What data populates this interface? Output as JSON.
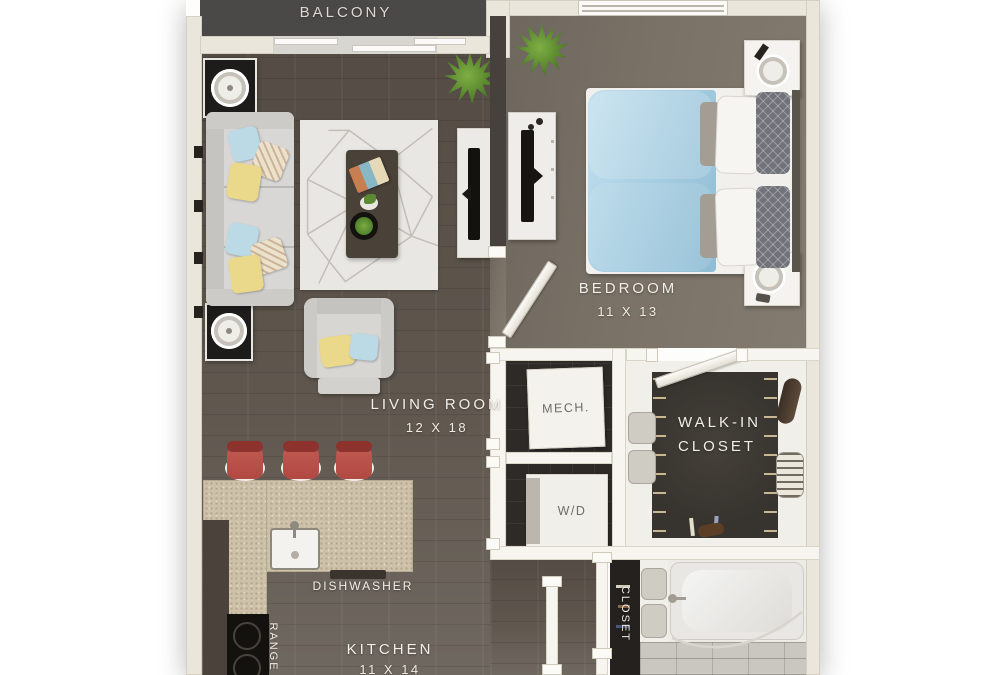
{
  "title": "One-bedroom apartment floor plan",
  "rooms": {
    "balcony": {
      "label": "BALCONY"
    },
    "bedroom": {
      "label": "BEDROOM",
      "dims": "11 X 13"
    },
    "living_room": {
      "label": "LIVING ROOM",
      "dims": "12 X 18"
    },
    "kitchen": {
      "label": "KITCHEN",
      "dims": "11 X 14"
    },
    "mech": {
      "label": "MECH."
    },
    "laundry": {
      "label": "W/D"
    },
    "walk_in_closet": {
      "line1": "WALK-IN",
      "line2": "CLOSET"
    },
    "hall_closet": {
      "label": "CLOSET"
    }
  },
  "appliances": {
    "dishwasher": {
      "label": "DISHWASHER"
    },
    "range": {
      "label": "RANGE"
    }
  },
  "colors": {
    "wood_floor": "#544c44",
    "wood_floor_light": "#6f6860",
    "bedroom_floor": "#7a7267",
    "balcony_floor": "#4b4948",
    "wall": "#eae6db",
    "wall_white": "#f7f5f0",
    "accent_wall": "#46413c",
    "closet_dark": "#37332e",
    "tile_dark": "#2d2a27",
    "counter_granite": "#cdc1a9",
    "stool_red": "#b14842",
    "duvet_blue": "#a9cfe2",
    "pillow_yellow": "#ead98a",
    "pillow_blue": "#bcd9e6",
    "plant_green": "#4e7d28",
    "bath_tile": "#cac7c1",
    "rug": "#e9e7e3",
    "sofa_gray": "#d8d7d5",
    "table_black": "#1e1c1b",
    "coffee_table": "#4a4138"
  }
}
